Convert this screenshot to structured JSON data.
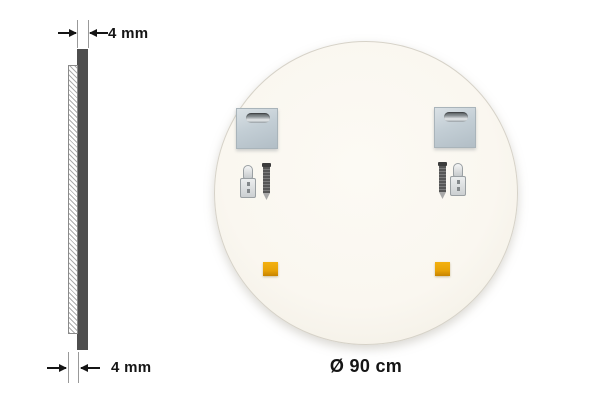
{
  "side_view": {
    "top_dimension": "4 mm",
    "bottom_dimension": "4 mm"
  },
  "back_view": {
    "diameter": "Ø 90 cm"
  },
  "colors": {
    "panel-dark": "#4e4e4e",
    "hatch-line": "#adadad",
    "plate-metal": "#c3ced5",
    "pad-orange": "#e8a307",
    "circle-cream": "#faf7f0",
    "dim-black": "#151515",
    "ext-gray": "#999999"
  },
  "icons": {
    "keyhole-slot-icon": "metallic keyhole hanging slot (rounded bar)",
    "wall-anchor-icon": "wall plug / dowel, front view",
    "screw-icon": "screw, side view, tip down",
    "adhesive-pad-icon": "orange square adhesive pad",
    "dimension-arrow-icon": "inward-pointing dimension arrows"
  }
}
